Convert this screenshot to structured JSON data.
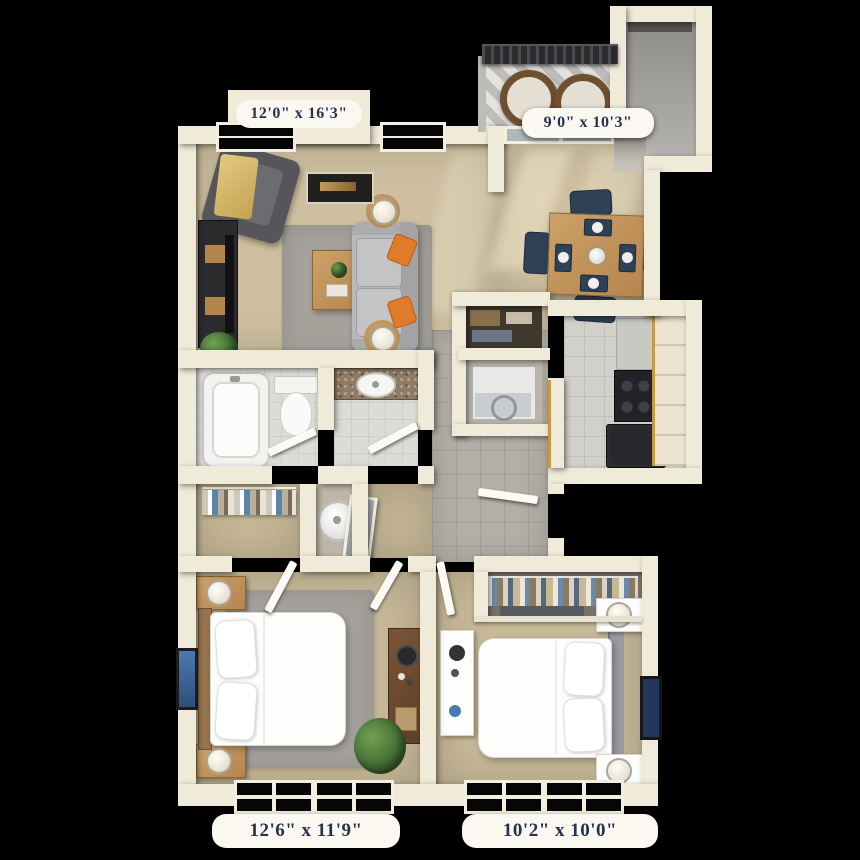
{
  "floor_plan": {
    "background_color": "#000000",
    "wall_color": "#f0ead9",
    "label_text_color": "#26324f",
    "label_background": "#faf8f0",
    "accent_colors": {
      "carpet": "#cdbf9f",
      "tile": "#b3afa6",
      "sofa_grey": "#b9b9bb",
      "pillow_orange": "#e07b2a",
      "wood": "#c89a62",
      "dining_chair_navy": "#2e4156",
      "cabinet_trim_gold": "#c49a4a"
    },
    "rooms": {
      "living_room": {
        "label": "12'0\" x 16'3\""
      },
      "balcony": {
        "label": "9'0\" x 10'3\""
      },
      "bedroom_1": {
        "label": "12'6\" x 11'9\""
      },
      "bedroom_2": {
        "label": "10'2\" x 10'0\""
      }
    }
  }
}
